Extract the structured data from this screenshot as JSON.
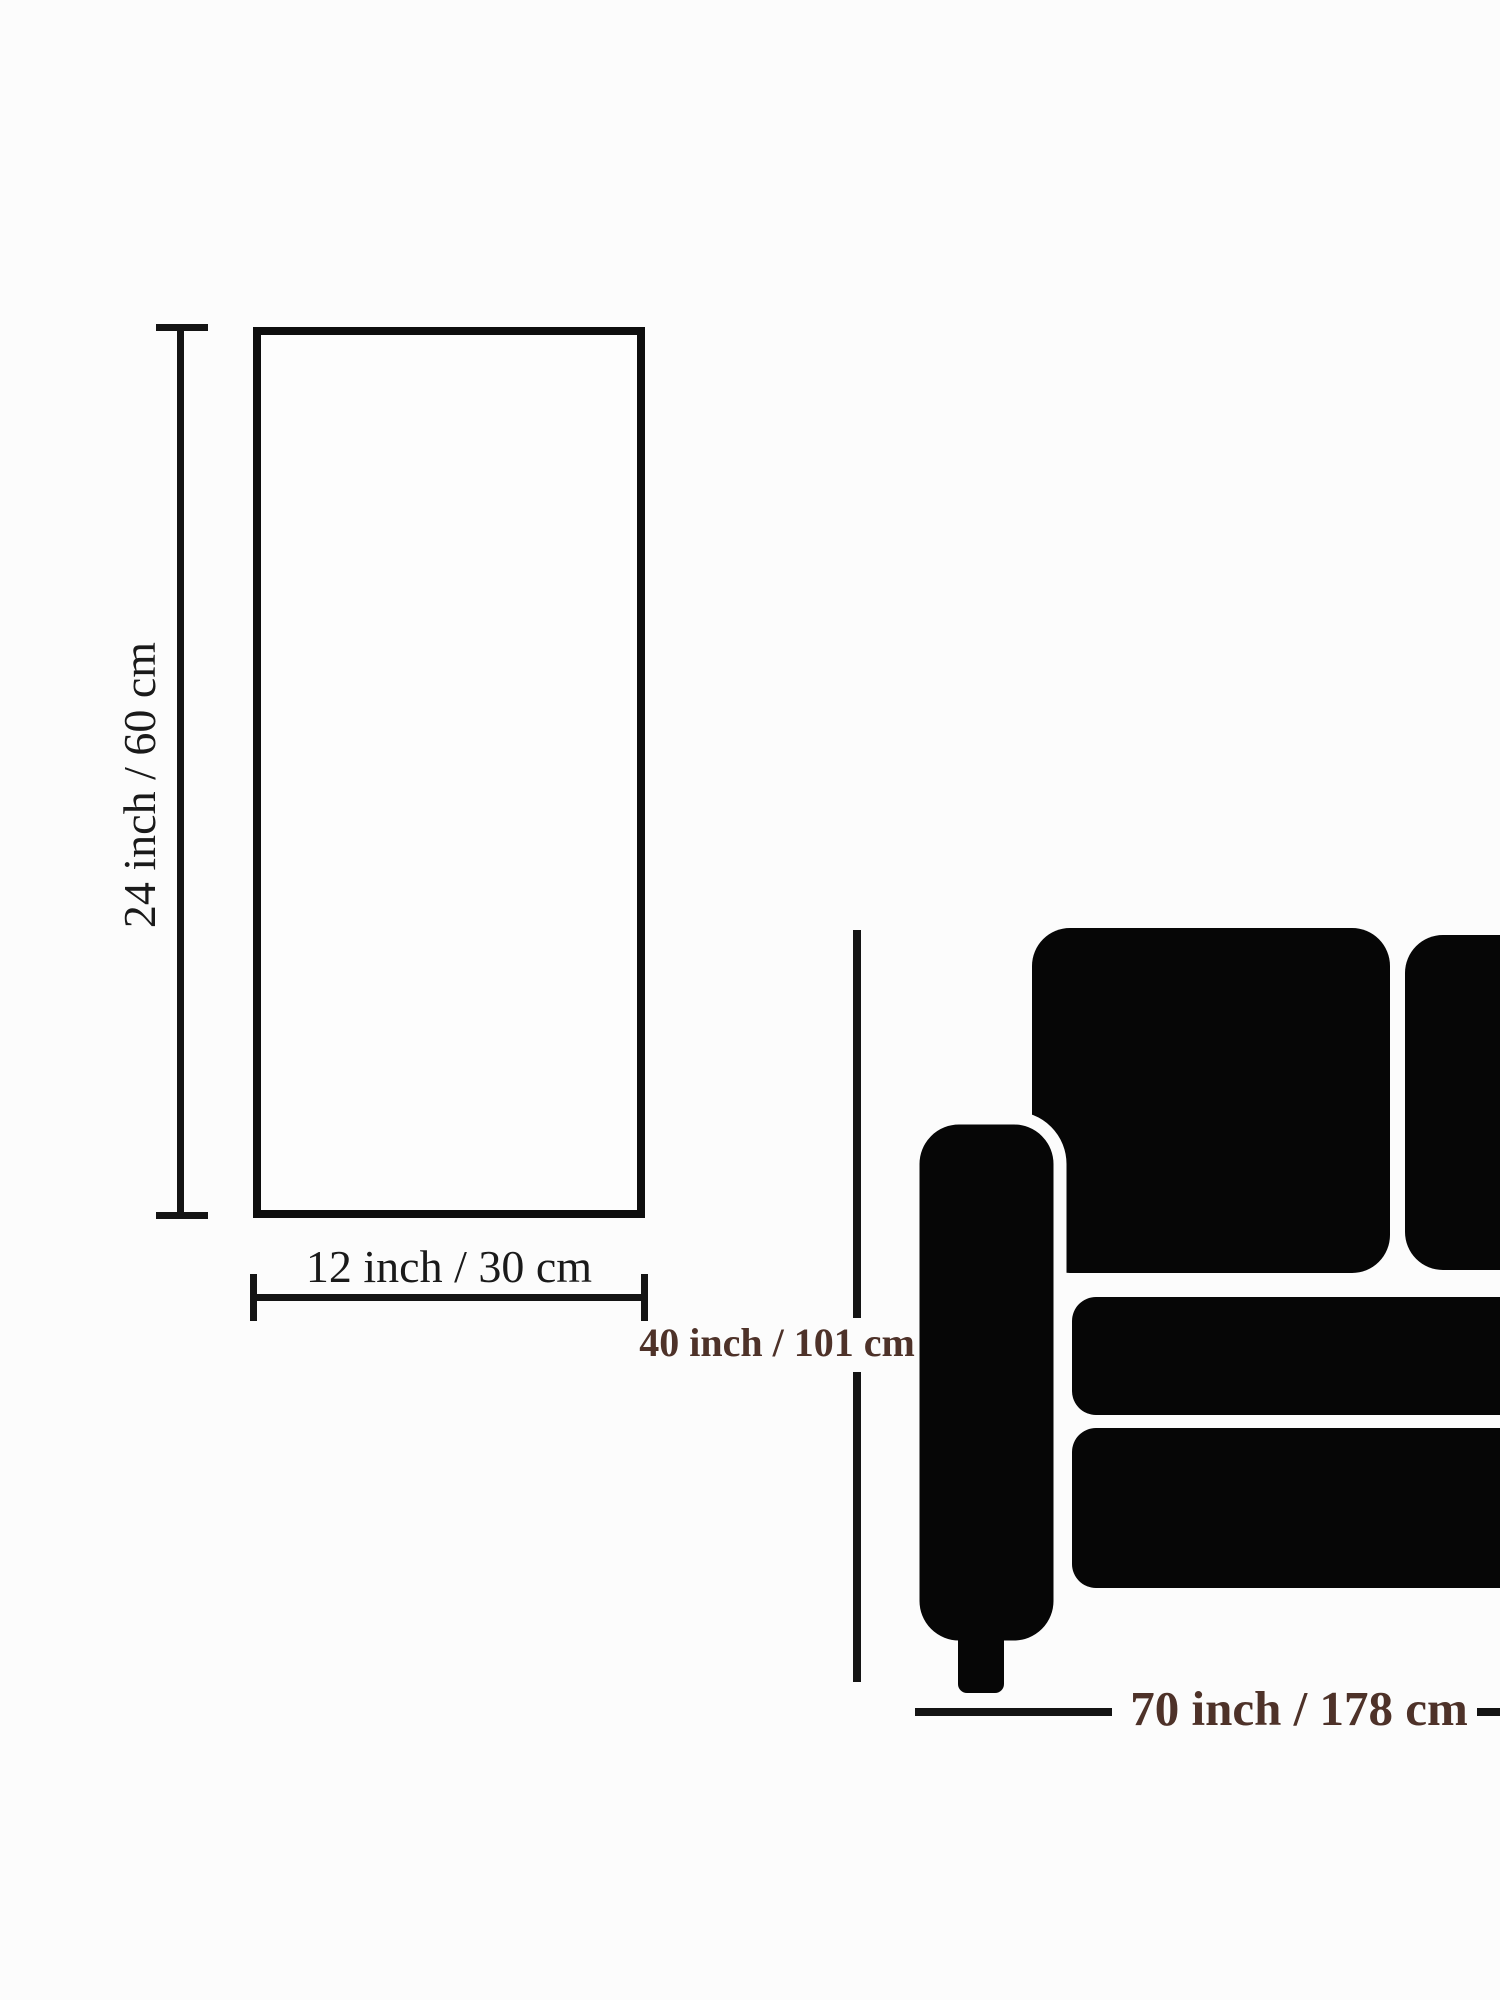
{
  "page": {
    "background": "#fcfcfc"
  },
  "canvas_panel": {
    "height_label": "24 inch / 60 cm",
    "width_label": "12 inch / 30 cm",
    "line_color": "#141414"
  },
  "sofa_panel": {
    "height_label": "40 inch / 101 cm",
    "width_label": "70 inch / 178 cm",
    "label_color": "#4e3229",
    "silhouette_color": "#060606"
  }
}
